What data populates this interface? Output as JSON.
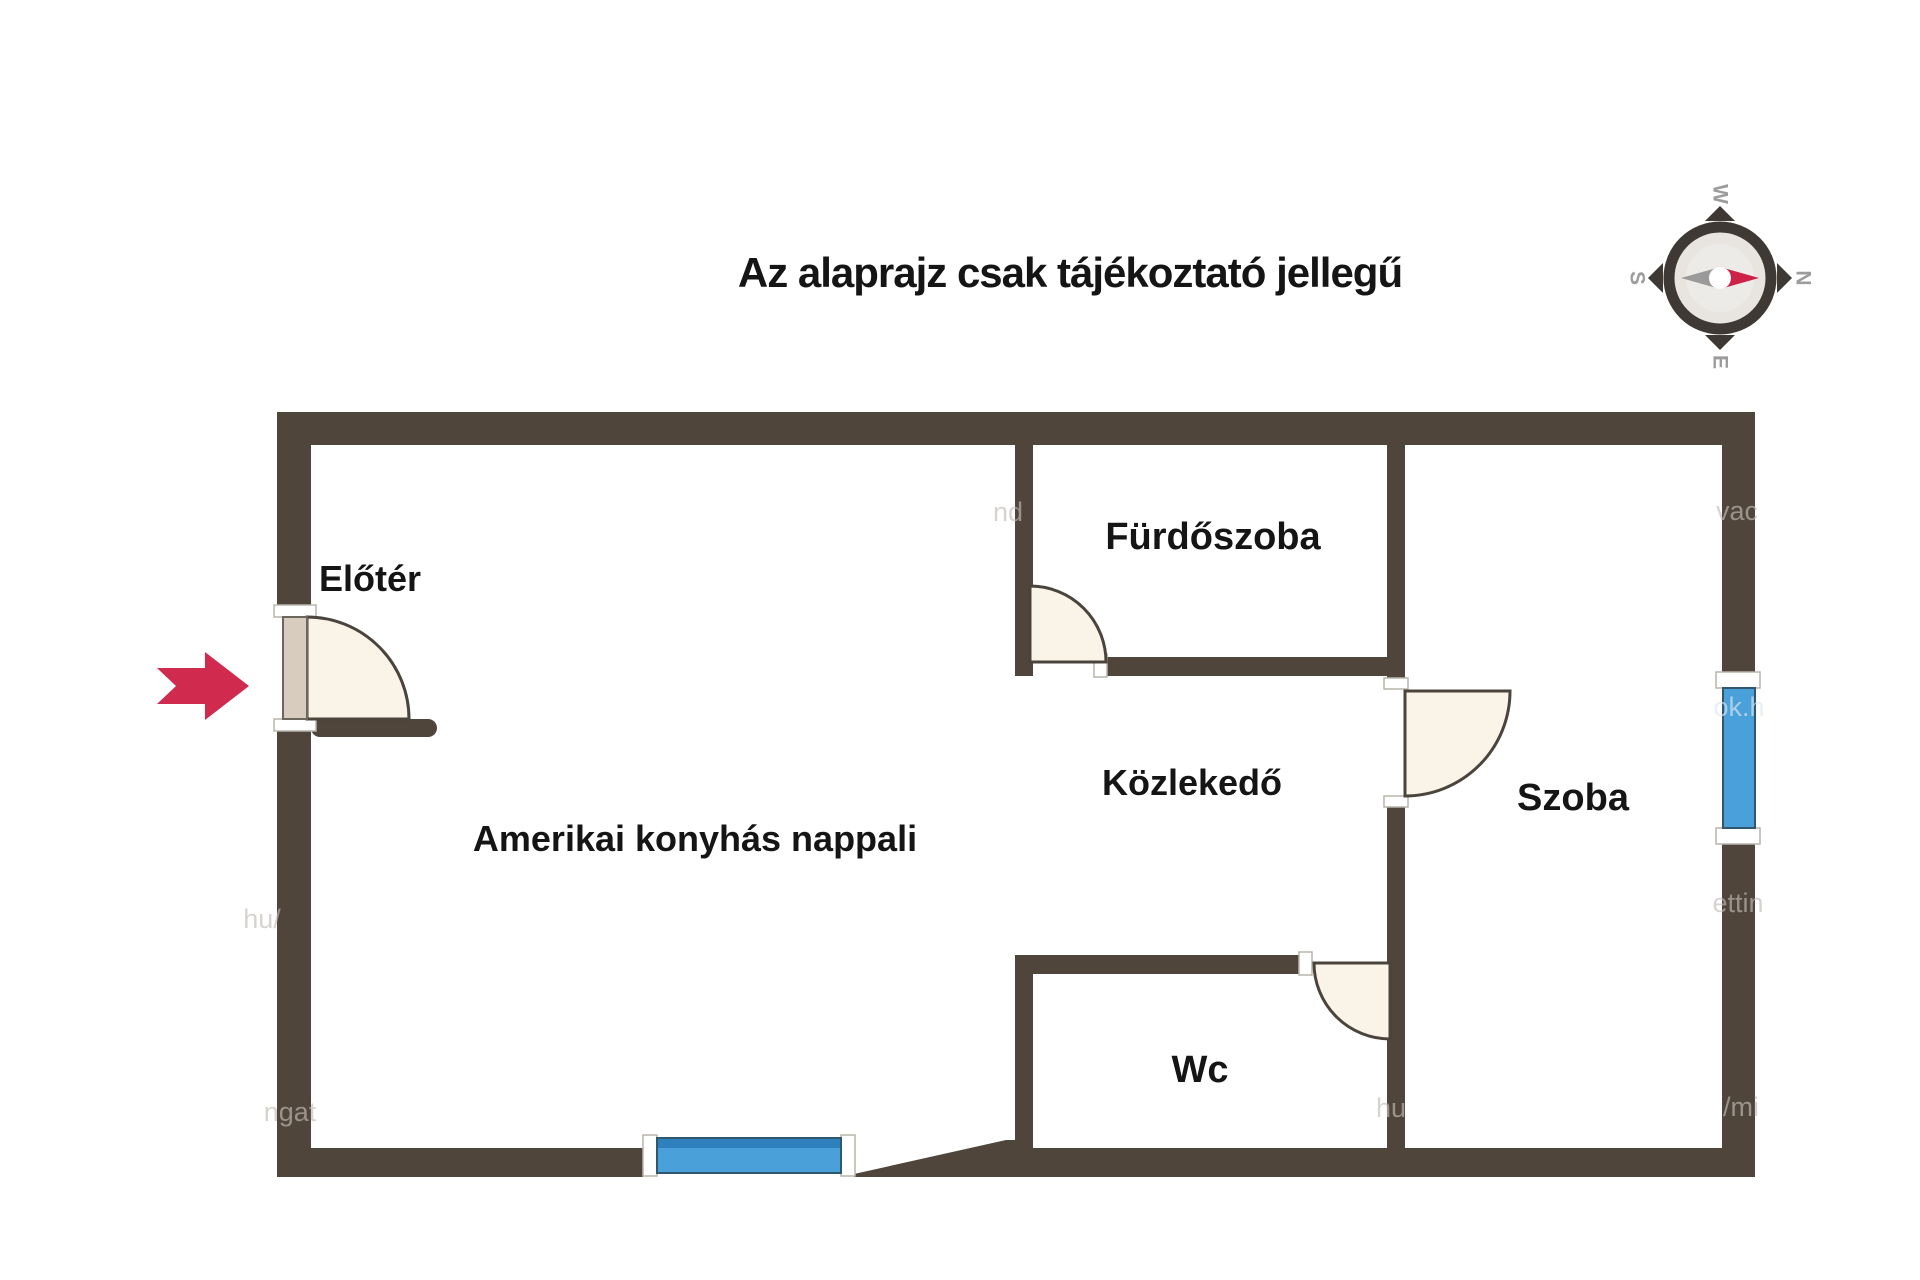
{
  "title": "Az alaprajz csak tájékoztató jellegű",
  "rooms": [
    {
      "name": "Előtér"
    },
    {
      "name": "Amerikai konyhás nappali"
    },
    {
      "name": "Fürdőszoba"
    },
    {
      "name": "Közlekedő"
    },
    {
      "name": "Wc"
    },
    {
      "name": "Szoba"
    }
  ],
  "compass": {
    "n": "N",
    "e": "E",
    "s": "S",
    "w": "W"
  },
  "watermarks": [
    "nd",
    "vac",
    "ok.h",
    "ettin",
    "/mi",
    "hu",
    "ngat",
    "hu/"
  ],
  "colors": {
    "wall": "#4f453b",
    "window": "#4aa0d9",
    "window_edge": "#2f81bd",
    "door_fill": "#faf3e8",
    "door_leaf": "#d7ccbe",
    "arrow": "#d02a4e",
    "compass_dark": "#3e3935",
    "compass_inner": "#e8e5e1",
    "needle_red": "#ce2147",
    "needle_gray": "#9a9a9a",
    "compass_letter": "#9c9c9c",
    "label": "#151515",
    "watermark": "#c2bdb6",
    "watermark_light": "#dce9f4"
  }
}
